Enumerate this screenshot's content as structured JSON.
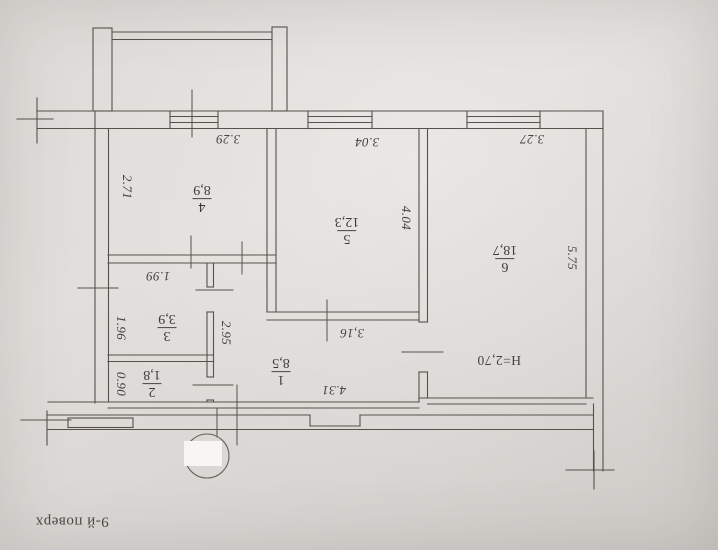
{
  "plan": {
    "floor_note": "9-й поверх",
    "height_note": "H=2,70",
    "rooms": [
      {
        "number": "4",
        "area": "8,9"
      },
      {
        "number": "5",
        "area": "12,3"
      },
      {
        "number": "6",
        "area": "18,7"
      },
      {
        "number": "3",
        "area": "3,9"
      },
      {
        "number": "2",
        "area": "1,8"
      },
      {
        "number": "1",
        "area": "8,5"
      }
    ],
    "dimensions": {
      "d329": "3.29",
      "d271": "2.71",
      "d304": "3.04",
      "d404": "4.04",
      "d327": "3.27",
      "d575": "5.75",
      "d199": "1.99",
      "d196": "1.96",
      "d295": "2.95",
      "d090": "0.90",
      "d316": "3,16",
      "d431": "4.31",
      "dh270": "H=2,70"
    }
  }
}
